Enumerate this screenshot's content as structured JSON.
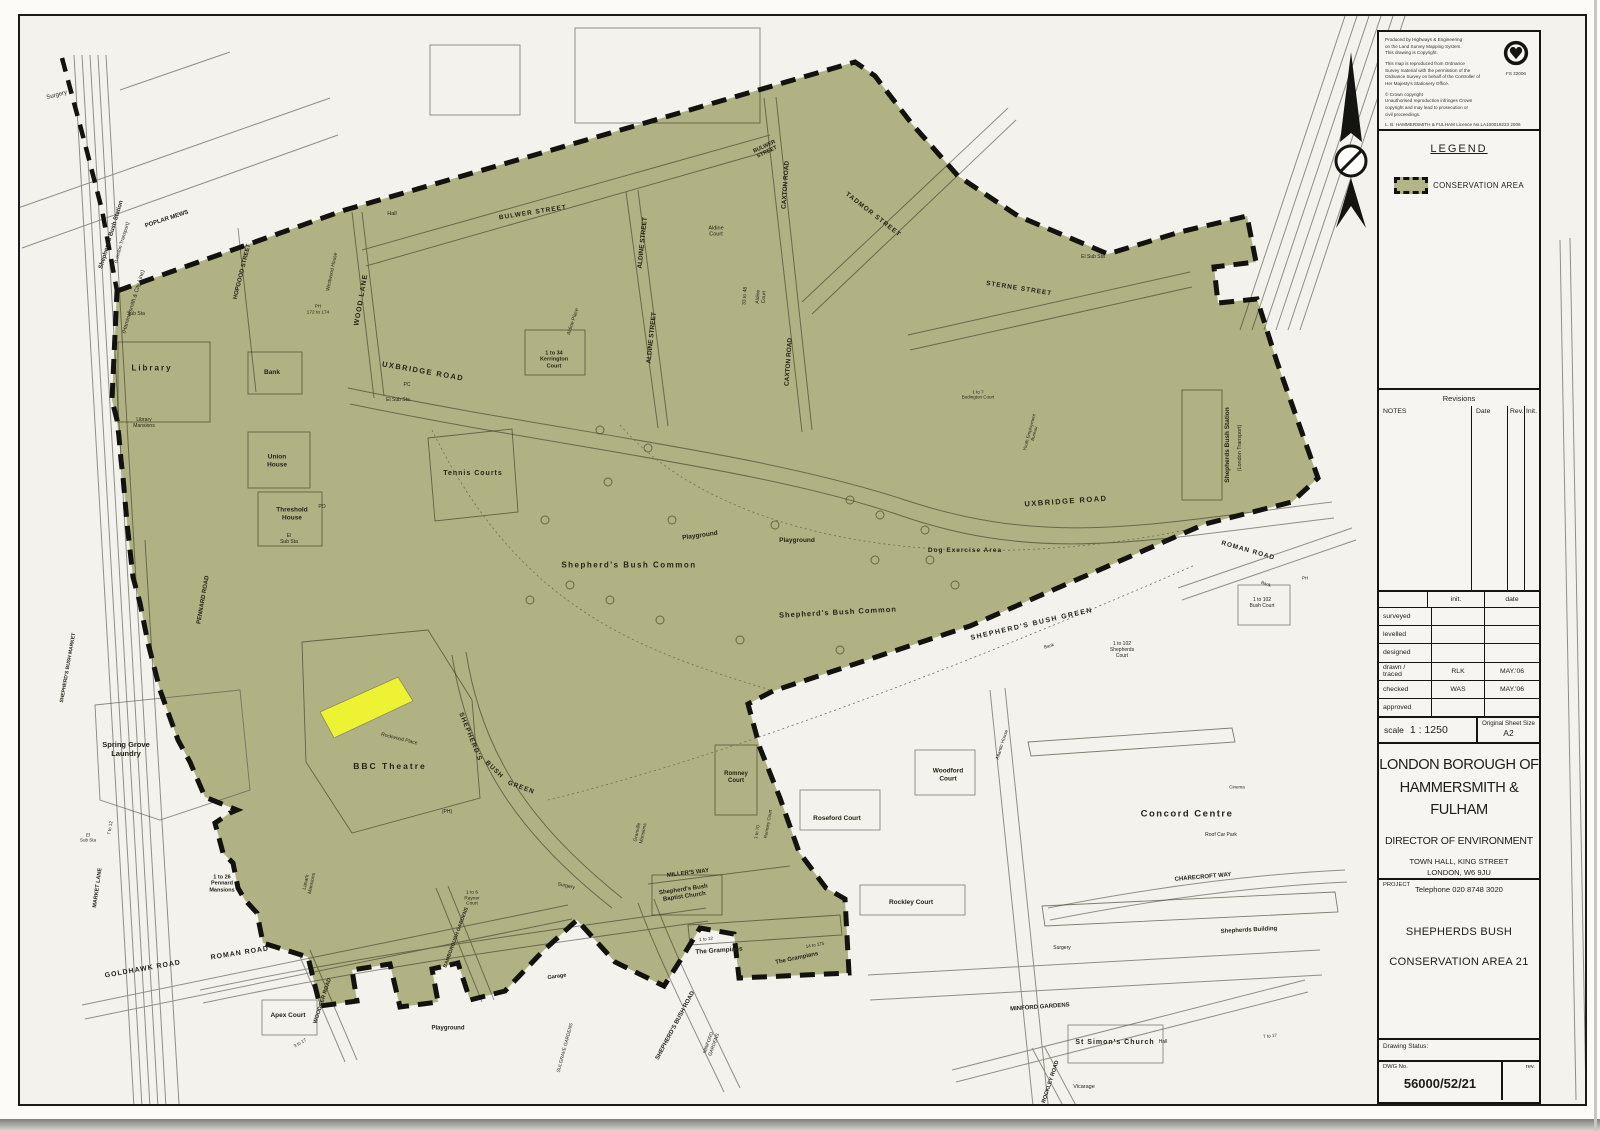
{
  "sheet": {
    "stamp": {
      "para1": "Produced by Highways & Engineering\non the Land Survey Mapping System.\nThis drawing is Copyright.",
      "para2": "This map is reproduced from Ordnance\nSurvey material with the permission of the\nOrdnance Survey on behalf of the Controller of\nHer Majesty's Stationery Office.",
      "para3": "© Crown copyright\nUnauthorised reproduction infringes Crown\ncopyright and may lead to prosecution or\ncivil proceedings.",
      "licence": "L. B. HAMMERSMITH & FULHAM   Licence No.LA100018223   2006",
      "badge_code": "FS 32006"
    },
    "legend": {
      "title": "LEGEND",
      "item": "CONSERVATION AREA"
    },
    "revisions": {
      "title": "Revisions",
      "notes": "NOTES",
      "date": "Date",
      "rev": "Rev.",
      "init": "Init."
    },
    "signoff": {
      "init_header": "init.",
      "date_header": "date",
      "rows": [
        {
          "label": "surveyed",
          "init": "",
          "date": ""
        },
        {
          "label": "levelled",
          "init": "",
          "date": ""
        },
        {
          "label": "designed",
          "init": "",
          "date": ""
        },
        {
          "label": "drawn /\n   traced",
          "init": "RLK",
          "date": "MAY.'06"
        },
        {
          "label": "checked",
          "init": "WAS",
          "date": "MAY.'06"
        },
        {
          "label": "approved",
          "init": "",
          "date": ""
        }
      ]
    },
    "scale": {
      "label": "scale",
      "value": "1 : 1250",
      "sheet_label": "Original Sheet Size",
      "sheet_value": "A2"
    },
    "authority": {
      "name": "LONDON BOROUGH OF\nHAMMERSMITH & FULHAM",
      "department": "DIRECTOR OF ENVIRONMENT",
      "address": "TOWN HALL, KING STREET\nLONDON, W6 9JU",
      "phone": "Telephone 020 8748 3020"
    },
    "project": {
      "label": "PROJECT",
      "line1": "SHEPHERDS BUSH",
      "line2": "CONSERVATION AREA 21"
    },
    "status": {
      "label": "Drawing Status:"
    },
    "dwg": {
      "label": "DWG No.",
      "number": "56000/52/21",
      "rev_label": "rev."
    }
  },
  "colors": {
    "conservation_fill": "#b2b684",
    "highlight_yellow": "#edf233",
    "boundary_black": "#12120e",
    "paper": "#f4f2ec"
  },
  "map_labels": [
    {
      "t": "Surgery",
      "x": 57,
      "y": 96,
      "r": -15,
      "s": 6,
      "w": 400
    },
    {
      "t": "Shepherd's Bush Station",
      "x": 112,
      "y": 235,
      "r": -73,
      "s": 6
    },
    {
      "t": "(London Transport)",
      "x": 123,
      "y": 243,
      "r": -73,
      "s": 5,
      "w": 400
    },
    {
      "t": "(Hammersmith & City Line)",
      "x": 134,
      "y": 302,
      "r": -73,
      "s": 5.5,
      "w": 400
    },
    {
      "t": "POPLAR MEWS",
      "x": 167,
      "y": 220,
      "r": -18,
      "s": 6
    },
    {
      "t": "HOPGOOD STREET",
      "x": 243,
      "y": 272,
      "r": -76,
      "s": 6
    },
    {
      "t": "Westwood House",
      "x": 333,
      "y": 272,
      "r": -78,
      "s": 5,
      "w": 400
    },
    {
      "t": "WOOD LANE",
      "x": 362,
      "y": 300,
      "r": -80,
      "s": 7,
      "ls": 1
    },
    {
      "t": "BULWER STREET",
      "x": 533,
      "y": 213,
      "r": -9,
      "s": 6.5,
      "ls": 1
    },
    {
      "t": "BULWER\nSTREET",
      "x": 766,
      "y": 150,
      "r": -25,
      "s": 5.5
    },
    {
      "t": "CAXTON ROAD",
      "x": 786,
      "y": 185,
      "r": -86,
      "s": 6.5
    },
    {
      "t": "CAXTON ROAD",
      "x": 789,
      "y": 362,
      "r": -86,
      "s": 6.5
    },
    {
      "t": "ALDINE STREET",
      "x": 643,
      "y": 243,
      "r": -84,
      "s": 6.5
    },
    {
      "t": "ALDINE STREET",
      "x": 652,
      "y": 338,
      "r": -84,
      "s": 6.5
    },
    {
      "t": "TADMOR STREET",
      "x": 873,
      "y": 215,
      "r": 38,
      "s": 6.5,
      "ls": 1
    },
    {
      "t": "STERNE STREET",
      "x": 1019,
      "y": 289,
      "r": 9,
      "s": 6.5,
      "ls": 1
    },
    {
      "t": "Hall",
      "x": 392,
      "y": 214,
      "s": 5.5,
      "w": 400
    },
    {
      "t": "Aldine\nCourt",
      "x": 716,
      "y": 232,
      "s": 5.5,
      "w": 400
    },
    {
      "t": "Aldine Place",
      "x": 574,
      "y": 322,
      "r": -72,
      "s": 5,
      "w": 400
    },
    {
      "t": "33 to 48",
      "x": 746,
      "y": 296,
      "r": -86,
      "s": 5,
      "w": 400
    },
    {
      "t": "Aldine\nCourt",
      "x": 762,
      "y": 297,
      "r": -86,
      "s": 5,
      "w": 400
    },
    {
      "t": "1 to 34\nKerrington\nCourt",
      "x": 554,
      "y": 360,
      "s": 5.5
    },
    {
      "t": "UXBRIDGE ROAD",
      "x": 423,
      "y": 372,
      "r": 10,
      "s": 7.5,
      "ls": 1.5
    },
    {
      "t": "UXBRIDGE ROAD",
      "x": 1066,
      "y": 502,
      "r": -4,
      "s": 7.5,
      "ls": 1.5
    },
    {
      "t": "El Sub Sta",
      "x": 398,
      "y": 401,
      "s": 5,
      "w": 400
    },
    {
      "t": "PC",
      "x": 407,
      "y": 386,
      "s": 5,
      "w": 400
    },
    {
      "t": "Library",
      "x": 152,
      "y": 368,
      "s": 8,
      "ls": 2
    },
    {
      "t": "Library\nMansions",
      "x": 144,
      "y": 424,
      "s": 5,
      "w": 400
    },
    {
      "t": "Bank",
      "x": 272,
      "y": 373,
      "s": 6.5
    },
    {
      "t": "Union\nHouse",
      "x": 277,
      "y": 461,
      "s": 6.5
    },
    {
      "t": "Threshold\nHouse",
      "x": 292,
      "y": 514,
      "s": 6.5
    },
    {
      "t": "El\nSub Sta",
      "x": 289,
      "y": 540,
      "s": 5,
      "w": 400
    },
    {
      "t": "PO",
      "x": 322,
      "y": 508,
      "s": 5,
      "w": 400
    },
    {
      "t": "PH\n172 to 174",
      "x": 318,
      "y": 310,
      "s": 4.8,
      "w": 400
    },
    {
      "t": "Sub Sta",
      "x": 136,
      "y": 315,
      "s": 5,
      "w": 400
    },
    {
      "t": "Tennis Courts",
      "x": 473,
      "y": 474,
      "s": 7,
      "ls": 1
    },
    {
      "t": "Shepherd's Bush Common",
      "x": 629,
      "y": 565,
      "s": 8,
      "ls": 1.5
    },
    {
      "t": "Shepherd's Bush Common",
      "x": 838,
      "y": 613,
      "r": -3,
      "s": 7.5,
      "ls": 1
    },
    {
      "t": "Playground",
      "x": 700,
      "y": 536,
      "r": -8,
      "s": 6.5
    },
    {
      "t": "Playground",
      "x": 797,
      "y": 541,
      "s": 6.5
    },
    {
      "t": "Dog Exercise Area",
      "x": 965,
      "y": 551,
      "s": 6.5,
      "ls": 1
    },
    {
      "t": "El Sub Sta",
      "x": 1093,
      "y": 258,
      "s": 5,
      "w": 400
    },
    {
      "t": "1 to 7\nBodington Court",
      "x": 978,
      "y": 395,
      "s": 4.5,
      "w": 400
    },
    {
      "t": "Youth Employment\nBureau",
      "x": 1032,
      "y": 433,
      "r": -75,
      "s": 4.5,
      "w": 400
    },
    {
      "t": "Shepherds Bush Station",
      "x": 1228,
      "y": 445,
      "r": -90,
      "s": 6.5
    },
    {
      "t": "(London Transport)",
      "x": 1240,
      "y": 448,
      "r": -90,
      "s": 5.5,
      "w": 400
    },
    {
      "t": "ROMAN ROAD",
      "x": 1248,
      "y": 551,
      "r": 16,
      "s": 6.5,
      "ls": 1
    },
    {
      "t": "SHEPHERD'S BUSH GREEN",
      "x": 1032,
      "y": 625,
      "r": -13,
      "s": 7,
      "ls": 1.5
    },
    {
      "t": "Bank",
      "x": 1266,
      "y": 584,
      "r": 20,
      "s": 4.5,
      "w": 400
    },
    {
      "t": "PH",
      "x": 1305,
      "y": 578,
      "s": 4.5,
      "w": 400
    },
    {
      "t": "1 to 102\nBush Court",
      "x": 1262,
      "y": 604,
      "s": 5,
      "w": 400
    },
    {
      "t": "1 to 102\nShepherds\nCourt",
      "x": 1122,
      "y": 651,
      "s": 5,
      "w": 400
    },
    {
      "t": "Bank",
      "x": 1049,
      "y": 646,
      "r": -15,
      "s": 4.5,
      "w": 400
    },
    {
      "t": "PENNARD ROAD",
      "x": 204,
      "y": 600,
      "r": -80,
      "s": 6
    },
    {
      "t": "SHEPHERD'S BUSH MARKET",
      "x": 69,
      "y": 668,
      "r": -80,
      "s": 5
    },
    {
      "t": "MARKET LANE",
      "x": 98,
      "y": 888,
      "r": -82,
      "s": 5.5
    },
    {
      "t": "Spring Grove\nLaundry",
      "x": 126,
      "y": 750,
      "s": 7.5
    },
    {
      "t": "El\nSub Sta",
      "x": 88,
      "y": 838,
      "s": 4.5,
      "w": 400
    },
    {
      "t": "7 to 12",
      "x": 110,
      "y": 828,
      "r": -80,
      "s": 4.5,
      "w": 400
    },
    {
      "t": "1 to 26\nPennard\nMansions",
      "x": 222,
      "y": 884,
      "s": 5.5
    },
    {
      "t": "Rockwood Place",
      "x": 399,
      "y": 740,
      "r": 14,
      "s": 5,
      "w": 400
    },
    {
      "t": "BBC Theatre",
      "x": 390,
      "y": 766,
      "s": 8.5,
      "ls": 2
    },
    {
      "t": "SHEPHERD'S",
      "x": 470,
      "y": 737,
      "r": 68,
      "s": 6.5,
      "ls": 1
    },
    {
      "t": "BUSH",
      "x": 494,
      "y": 770,
      "r": 44,
      "s": 6.5,
      "ls": 1
    },
    {
      "t": "GREEN",
      "x": 521,
      "y": 788,
      "r": 20,
      "s": 6.5,
      "ls": 1
    },
    {
      "t": "(PH)",
      "x": 447,
      "y": 813,
      "s": 5,
      "w": 400
    },
    {
      "t": "Lanark\nMansions",
      "x": 310,
      "y": 883,
      "r": -78,
      "s": 5,
      "w": 400
    },
    {
      "t": "ROMAN ROAD",
      "x": 240,
      "y": 954,
      "r": -9,
      "s": 7,
      "ls": 1
    },
    {
      "t": "GOLDHAWK ROAD",
      "x": 143,
      "y": 970,
      "r": -10,
      "s": 7,
      "ls": 1
    },
    {
      "t": "Apex Court",
      "x": 288,
      "y": 1016,
      "s": 6.5
    },
    {
      "t": "3 to 17",
      "x": 300,
      "y": 1043,
      "r": -30,
      "s": 4.5,
      "w": 400
    },
    {
      "t": "WOODGER ROAD",
      "x": 323,
      "y": 1001,
      "r": -72,
      "s": 5.5
    },
    {
      "t": "Playground",
      "x": 448,
      "y": 1029,
      "s": 6
    },
    {
      "t": "BAMBOROUGH GARDENS",
      "x": 457,
      "y": 938,
      "r": -70,
      "s": 5
    },
    {
      "t": "1 to 6\nRayner\nCourt",
      "x": 472,
      "y": 899,
      "s": 4.8,
      "w": 400
    },
    {
      "t": "Surgery",
      "x": 566,
      "y": 887,
      "r": 12,
      "s": 5,
      "w": 400
    },
    {
      "t": "Garage",
      "x": 557,
      "y": 977,
      "r": -8,
      "s": 5.5
    },
    {
      "t": "SULGRAVE GARDENS",
      "x": 566,
      "y": 1048,
      "r": -75,
      "s": 4.8,
      "w": 400
    },
    {
      "t": "SHEPHERD'S BUSH ROAD",
      "x": 676,
      "y": 1026,
      "r": -62,
      "s": 6
    },
    {
      "t": "MILLER'S WAY",
      "x": 688,
      "y": 874,
      "r": -7,
      "s": 6
    },
    {
      "t": "Romney\nCourt",
      "x": 736,
      "y": 778,
      "s": 6
    },
    {
      "t": "1 to 70",
      "x": 757,
      "y": 832,
      "r": -80,
      "s": 4.5,
      "w": 400
    },
    {
      "t": "Romney Court",
      "x": 768,
      "y": 824,
      "r": -80,
      "s": 4.5,
      "w": 400
    },
    {
      "t": "Shepherd's Bush\nBaptist Church",
      "x": 684,
      "y": 894,
      "r": -8,
      "s": 6
    },
    {
      "t": "Granville\nMansions",
      "x": 641,
      "y": 833,
      "r": -78,
      "s": 4.8,
      "w": 400
    },
    {
      "t": "1 to 12",
      "x": 706,
      "y": 939,
      "r": -5,
      "s": 4.5,
      "w": 400
    },
    {
      "t": "The Grampians",
      "x": 719,
      "y": 951,
      "r": -4,
      "s": 6.5
    },
    {
      "t": "14 to 175",
      "x": 815,
      "y": 945,
      "r": -10,
      "s": 4.5,
      "w": 400
    },
    {
      "t": "The Grampians",
      "x": 797,
      "y": 959,
      "r": -12,
      "s": 6
    },
    {
      "t": "Roseford Court",
      "x": 837,
      "y": 819,
      "s": 6.5
    },
    {
      "t": "Woodford\nCourt",
      "x": 948,
      "y": 775,
      "s": 6.5
    },
    {
      "t": "Rockley Court",
      "x": 911,
      "y": 903,
      "s": 6.5
    },
    {
      "t": "Surgery",
      "x": 1062,
      "y": 949,
      "s": 5,
      "w": 400
    },
    {
      "t": "Atlantic House",
      "x": 1003,
      "y": 745,
      "r": -72,
      "s": 4.8,
      "w": 400
    },
    {
      "t": "Concord Centre",
      "x": 1187,
      "y": 814,
      "s": 9.5,
      "ls": 1.5
    },
    {
      "t": "Roof Car Park",
      "x": 1221,
      "y": 836,
      "s": 5,
      "w": 400
    },
    {
      "t": "Cinema",
      "x": 1237,
      "y": 787,
      "s": 4.5,
      "w": 400
    },
    {
      "t": "CHARECROFT WAY",
      "x": 1203,
      "y": 878,
      "r": -5,
      "s": 6
    },
    {
      "t": "Shepherds Building",
      "x": 1249,
      "y": 931,
      "r": -3,
      "s": 6
    },
    {
      "t": "MINFORD\nGARDENS",
      "x": 712,
      "y": 1044,
      "r": -70,
      "s": 4.8,
      "w": 400
    },
    {
      "t": "MINFORD GARDENS",
      "x": 1040,
      "y": 1008,
      "r": -4,
      "s": 6
    },
    {
      "t": "St Simon's Church",
      "x": 1115,
      "y": 1043,
      "s": 7,
      "ls": 1
    },
    {
      "t": "Hall",
      "x": 1163,
      "y": 1043,
      "s": 5,
      "w": 400
    },
    {
      "t": "Vicarage",
      "x": 1084,
      "y": 1087,
      "s": 5.5,
      "w": 400
    },
    {
      "t": "ROCKLEY ROAD",
      "x": 1051,
      "y": 1082,
      "r": -72,
      "s": 5.5
    },
    {
      "t": "7 to 17",
      "x": 1270,
      "y": 1036,
      "r": -5,
      "s": 4.5,
      "w": 400
    }
  ]
}
